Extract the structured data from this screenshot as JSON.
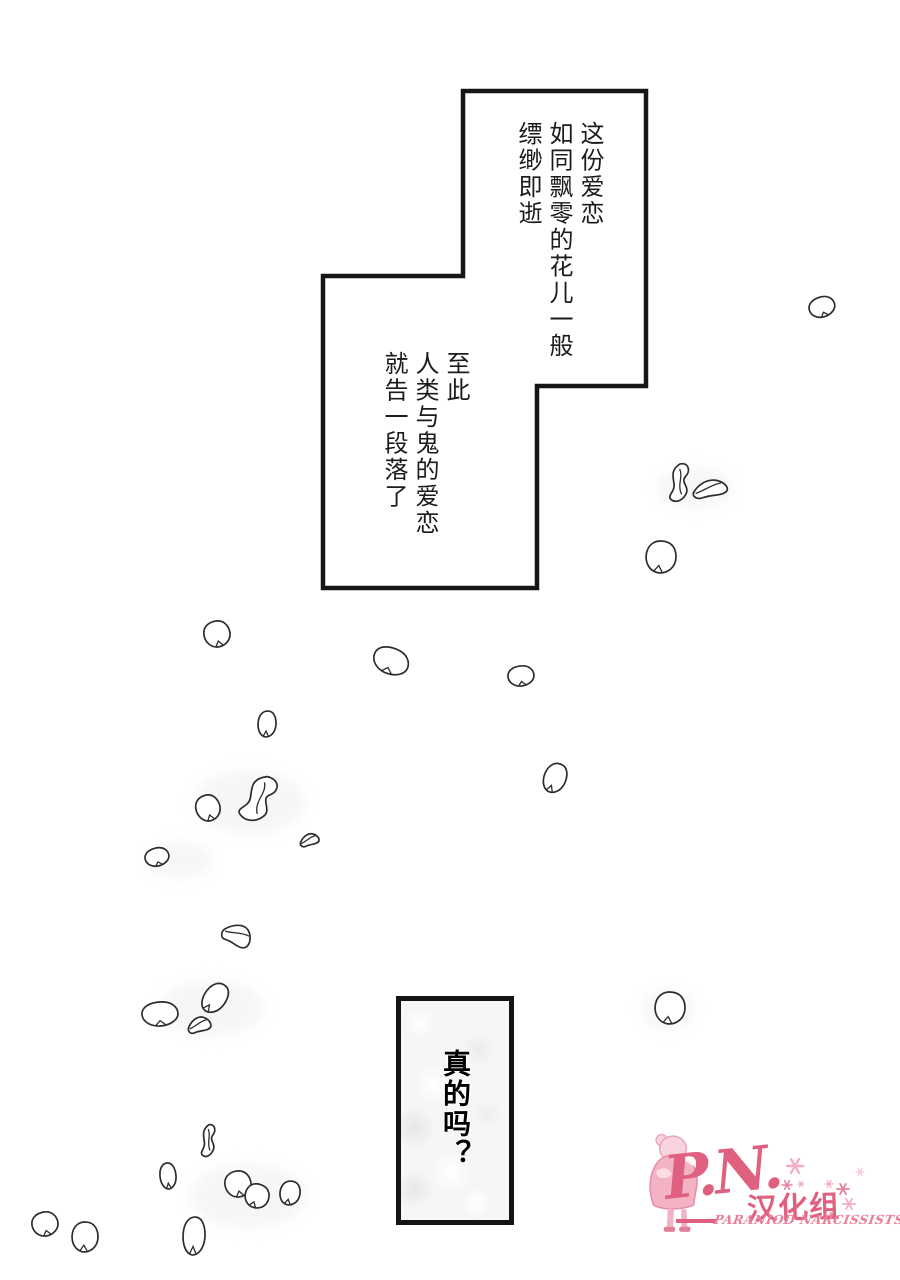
{
  "narration_top": {
    "lines": [
      "这份爱恋",
      "如同飘零的花儿一般",
      "缥缈即逝"
    ]
  },
  "narration_bottom": {
    "lines": [
      "至此",
      "人类与鬼的爱恋",
      "就告一段落了"
    ]
  },
  "speech_box": {
    "text": "真的吗？"
  },
  "logo": {
    "initials": "P.N.",
    "group_name": "汉化组",
    "subtitle": "PARANIOD NARCISSISTS",
    "accent": "#e0607f",
    "subtitle_color": "#ea7f9a",
    "figure_pink": "#f4b2c5"
  },
  "artwork": {
    "ink": "#2d2d2d",
    "panel_border_color": "#161616",
    "petals": [
      {
        "x": 822,
        "y": 307,
        "kind": "oval",
        "rx": 13,
        "ry": 10,
        "rot": -18
      },
      {
        "x": 679,
        "y": 483,
        "kind": "twist",
        "rx": 11,
        "ry": 19,
        "rot": 8
      },
      {
        "x": 711,
        "y": 489,
        "kind": "fold",
        "rx": 18,
        "ry": 10,
        "rot": -5
      },
      {
        "x": 661,
        "y": 557,
        "kind": "oval",
        "rx": 15,
        "ry": 16,
        "rot": 12
      },
      {
        "x": 217,
        "y": 634,
        "kind": "oval",
        "rx": 13,
        "ry": 13,
        "rot": -12
      },
      {
        "x": 391,
        "y": 661,
        "kind": "oval",
        "rx": 18,
        "ry": 13,
        "rot": 22
      },
      {
        "x": 267,
        "y": 724,
        "kind": "oval",
        "rx": 9,
        "ry": 13,
        "rot": 6
      },
      {
        "x": 521,
        "y": 676,
        "kind": "oval",
        "rx": 13,
        "ry": 10,
        "rot": -8
      },
      {
        "x": 555,
        "y": 778,
        "kind": "oval",
        "rx": 11,
        "ry": 15,
        "rot": 24
      },
      {
        "x": 208,
        "y": 808,
        "kind": "oval",
        "rx": 12,
        "ry": 13,
        "rot": -15
      },
      {
        "x": 258,
        "y": 799,
        "kind": "twist",
        "rx": 17,
        "ry": 24,
        "rot": 28
      },
      {
        "x": 310,
        "y": 840,
        "kind": "fold",
        "rx": 10,
        "ry": 7,
        "rot": -8
      },
      {
        "x": 157,
        "y": 857,
        "kind": "oval",
        "rx": 12,
        "ry": 9,
        "rot": -14
      },
      {
        "x": 238,
        "y": 936,
        "kind": "fold",
        "rx": 15,
        "ry": 13,
        "rot": 38
      },
      {
        "x": 160,
        "y": 1014,
        "kind": "oval",
        "rx": 18,
        "ry": 12,
        "rot": -4
      },
      {
        "x": 215,
        "y": 998,
        "kind": "oval",
        "rx": 11,
        "ry": 16,
        "rot": 38
      },
      {
        "x": 200,
        "y": 1025,
        "kind": "fold",
        "rx": 12,
        "ry": 9,
        "rot": -6
      },
      {
        "x": 670,
        "y": 1008,
        "kind": "oval",
        "rx": 15,
        "ry": 16,
        "rot": 10
      },
      {
        "x": 208,
        "y": 1141,
        "kind": "twist",
        "rx": 8,
        "ry": 16,
        "rot": 6
      },
      {
        "x": 168,
        "y": 1176,
        "kind": "oval",
        "rx": 8,
        "ry": 13,
        "rot": -4
      },
      {
        "x": 238,
        "y": 1184,
        "kind": "oval",
        "rx": 13,
        "ry": 13,
        "rot": -10
      },
      {
        "x": 257,
        "y": 1196,
        "kind": "oval",
        "rx": 12,
        "ry": 12,
        "rot": 25
      },
      {
        "x": 290,
        "y": 1193,
        "kind": "oval",
        "rx": 10,
        "ry": 12,
        "rot": 14
      },
      {
        "x": 45,
        "y": 1224,
        "kind": "oval",
        "rx": 13,
        "ry": 12,
        "rot": -12
      },
      {
        "x": 85,
        "y": 1237,
        "kind": "oval",
        "rx": 13,
        "ry": 15,
        "rot": 6
      },
      {
        "x": 194,
        "y": 1236,
        "kind": "oval",
        "rx": 11,
        "ry": 19,
        "rot": 4
      }
    ],
    "smudges": [
      {
        "x": 250,
        "y": 802,
        "rx": 55,
        "ry": 32
      },
      {
        "x": 180,
        "y": 860,
        "rx": 32,
        "ry": 18
      },
      {
        "x": 212,
        "y": 1008,
        "rx": 52,
        "ry": 28
      },
      {
        "x": 248,
        "y": 1196,
        "rx": 58,
        "ry": 32
      },
      {
        "x": 695,
        "y": 488,
        "rx": 38,
        "ry": 20
      },
      {
        "x": 668,
        "y": 1010,
        "rx": 26,
        "ry": 20
      }
    ],
    "sparkles": [
      {
        "x": 795,
        "y": 1166,
        "r": 8,
        "c": "#f3aec2"
      },
      {
        "x": 787,
        "y": 1185,
        "r": 5,
        "c": "#e8809b"
      },
      {
        "x": 801,
        "y": 1184,
        "r": 3,
        "c": "#f3aec2"
      },
      {
        "x": 829,
        "y": 1184,
        "r": 4,
        "c": "#f3aec2"
      },
      {
        "x": 843,
        "y": 1189,
        "r": 6,
        "c": "#e8809b"
      },
      {
        "x": 849,
        "y": 1204,
        "r": 6,
        "c": "#f3aec2"
      },
      {
        "x": 832,
        "y": 1215,
        "r": 3,
        "c": "#e8809b"
      },
      {
        "x": 860,
        "y": 1172,
        "r": 4,
        "c": "#f6c3d1"
      }
    ]
  }
}
